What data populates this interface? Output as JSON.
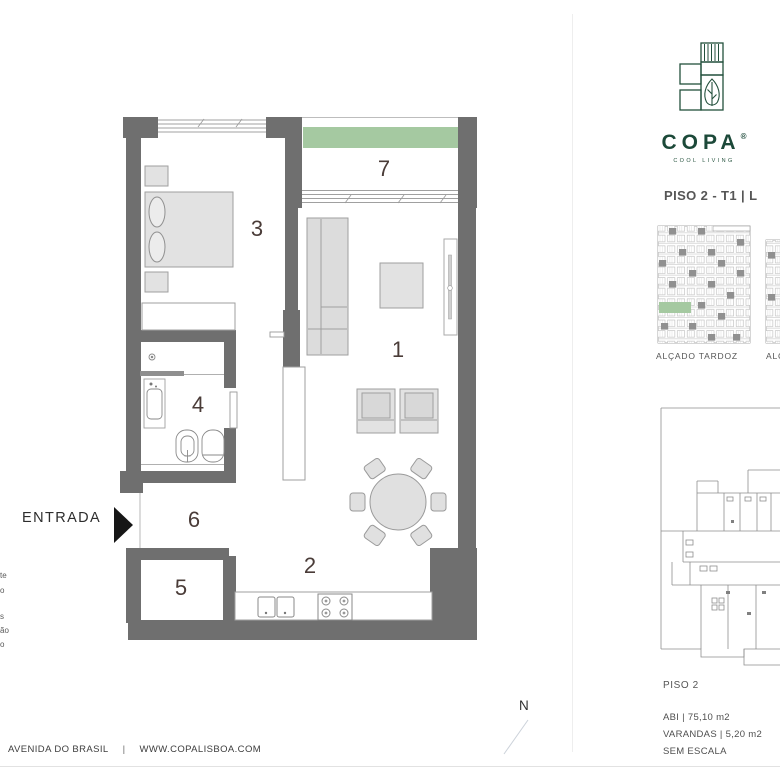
{
  "branding": {
    "name": "COPA",
    "registered": "®",
    "tagline": "COOL LIVING"
  },
  "unit": {
    "title": "PISO 2 - T1 | L",
    "floor_label": "PISO 2",
    "area_abi": "ABI | 75,10 m2",
    "area_varandas": "VARANDAS |  5,20 m2",
    "scale_note": "SEM ESCALA"
  },
  "elevations": {
    "left_label": "ALÇADO TARDOZ",
    "right_label_partial": "ALÇ"
  },
  "floorplan": {
    "entrance_label": "ENTRADA",
    "compass": "N",
    "rooms": {
      "living": "1",
      "kitchen": "2",
      "bedroom": "3",
      "bathroom": "4",
      "storage": "5",
      "hall": "6",
      "balcony": "7"
    },
    "legend_fragments": [
      "te",
      "o",
      "s",
      "ão",
      "o"
    ]
  },
  "footer": {
    "address": "AVENIDA DO BRASIL",
    "separator": "|",
    "website": "WWW.COPALISBOA.COM"
  },
  "colors": {
    "wall_gray": "#6f6f6f",
    "highlight_green": "#a5c9a1",
    "brand_green": "#1c4939"
  }
}
